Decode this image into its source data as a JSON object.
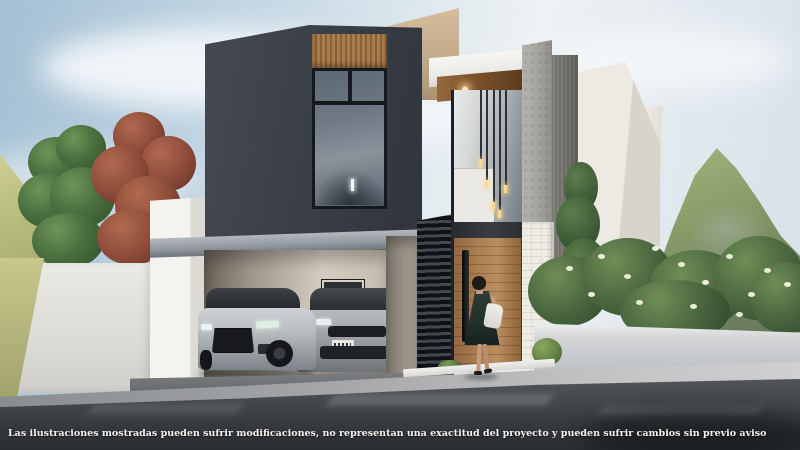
{
  "scene": {
    "type": "3d-architectural-exterior-render",
    "subject": "Modern two-story residence with charcoal upper volume, wood-clad entry canopy, double-height glazing, open carport with two sedans, landscaped planters and mountain backdrop",
    "figures": [
      "woman in dark dress carrying a white bag walking toward the wooden front door"
    ],
    "vehicles": [
      "silver sedan parked in carport",
      "gray sedan parked in carport"
    ]
  },
  "disclaimer": {
    "text": "Las ilustraciones mostradas pueden sufrir modificaciones, no representan una exactitud del proyecto y pueden sufrir cambios sin previo aviso"
  },
  "palette": {
    "sky_blue": "#a4c0d4",
    "cloud_white": "#f4f7f9",
    "charcoal_facade": "#3a3e46",
    "beige_wall": "#c2aa89",
    "white_wall": "#eae8e3",
    "wood_accent": "#a87c50",
    "concrete_gray": "#a3a29d",
    "mountain_green": "#8ba06b",
    "foliage_green": "#4a6740",
    "foliage_red": "#8e4c3a",
    "glass_blue_gray": "#6e7985",
    "road_gray": "#34383c",
    "disclaimer_text": "#f6f4f0"
  }
}
